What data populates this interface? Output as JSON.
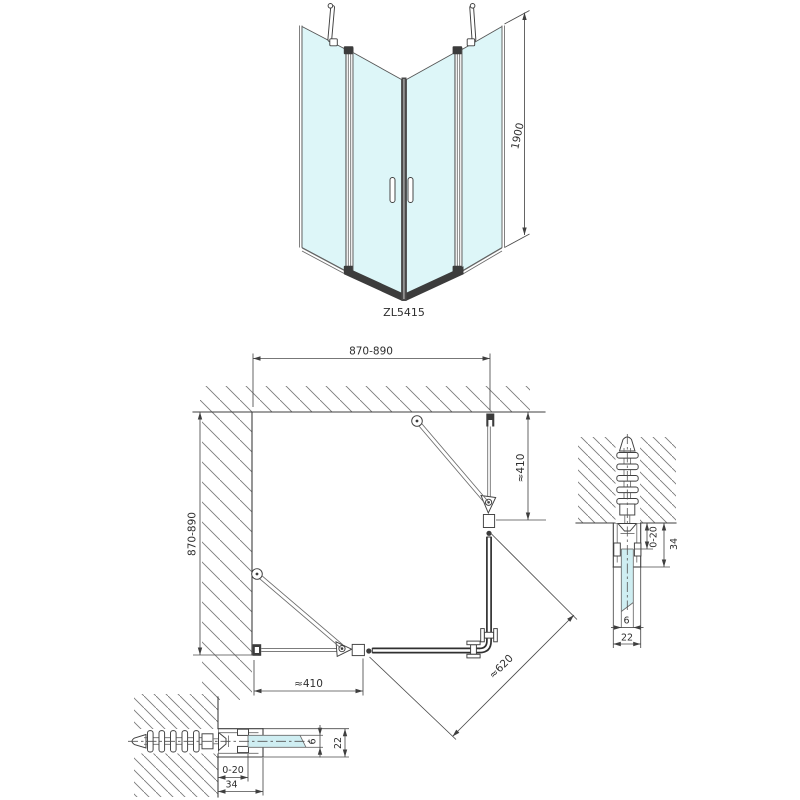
{
  "front_view": {
    "height_dimension": "1900",
    "product_code": "ZL5415"
  },
  "plan_view": {
    "top_width": "870-890",
    "left_depth": "870-890",
    "right_segment": "≈410",
    "bottom_segment": "≈410",
    "diagonal_entry": "≈620"
  },
  "detail_right": {
    "wall_gap": "0-20",
    "profile_depth": "34",
    "glass_thickness": "6",
    "profile_width": "22"
  },
  "detail_bottom": {
    "wall_gap": "0-20",
    "profile_depth": "34",
    "glass_thickness": "6",
    "profile_width": "22"
  },
  "colors": {
    "glass": "#ddf6f8",
    "detail_glass": "#cfeef2",
    "frame_dark": "#3c3c3c"
  }
}
